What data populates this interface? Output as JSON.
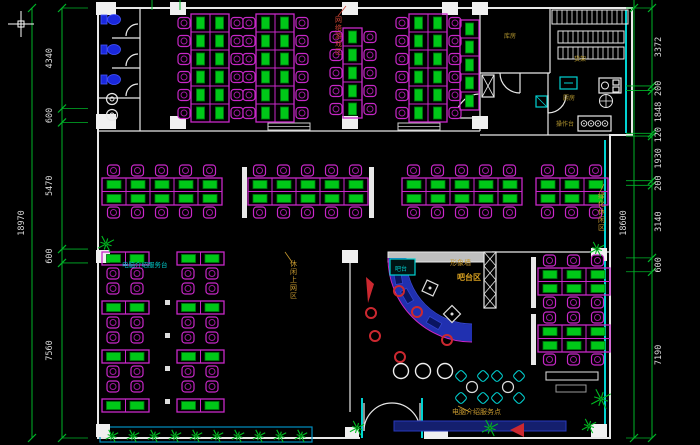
{
  "colors": {
    "bg": "#000000",
    "wall": "#e8e8e8",
    "wall_fill": "#f0f0f0",
    "grey": "#9a9a9a",
    "magenta": "#c828c8",
    "magenta_dark": "#a018a0",
    "green": "#00c818",
    "green_dark": "#007710",
    "dim_green": "#00b428",
    "dim_text": "#d8d8d8",
    "cyan": "#00d2d2",
    "blue_counter": "#2030b0",
    "blue_counter_dark": "#141f6e",
    "toilet_blue": "#1a28dd",
    "red": "#cc2830",
    "yellow": "#c89a30",
    "plant_green": "#00bb22"
  },
  "dimensions": {
    "left": {
      "overall": "18970",
      "segments": [
        "4340",
        "600",
        "5470",
        "600",
        "7560"
      ]
    },
    "right": {
      "overall": "18600",
      "segments": [
        "3372",
        "200",
        "1848",
        "120",
        "1930",
        "200",
        "3140",
        "600",
        "7190"
      ]
    }
  },
  "annotations": [
    {
      "id": "service-desk-left",
      "text": "电脑介绍服务台",
      "x": 122,
      "y": 267,
      "color": "#00c8c8",
      "size": 6.5,
      "vertical": false,
      "bold": false
    },
    {
      "id": "zone-top",
      "text": "网络游戏区",
      "x": 335,
      "y": 22,
      "color": "#cc4433",
      "size": 7,
      "vertical": true,
      "bold": false
    },
    {
      "id": "zone-mid",
      "text": "休闲上网区",
      "x": 290,
      "y": 266,
      "color": "#c89a30",
      "size": 7,
      "vertical": true,
      "bold": false
    },
    {
      "id": "zone-right",
      "text": "绿化休闲区",
      "x": 598,
      "y": 198,
      "color": "#c89a30",
      "size": 7,
      "vertical": true,
      "bold": false
    },
    {
      "id": "feature-wall-label",
      "text": "形象墙",
      "x": 450,
      "y": 265,
      "color": "#c89a30",
      "size": 7,
      "vertical": false,
      "bold": false
    },
    {
      "id": "bar-zone-label",
      "text": "吧台区",
      "x": 457,
      "y": 280,
      "color": "#d8a020",
      "size": 8,
      "vertical": false,
      "bold": true
    },
    {
      "id": "service-desk-bottom",
      "text": "电脑介绍服务点",
      "x": 452,
      "y": 414,
      "color": "#c89a30",
      "size": 7,
      "vertical": false,
      "bold": false
    },
    {
      "id": "room-store-label",
      "text": "库房",
      "x": 504,
      "y": 38,
      "color": "#b89a30",
      "size": 6,
      "vertical": false,
      "bold": false
    },
    {
      "id": "rack-label",
      "text": "货架",
      "x": 574,
      "y": 61,
      "color": "#b89a30",
      "size": 6,
      "vertical": false,
      "bold": false
    },
    {
      "id": "kitchen-label",
      "text": "厨房",
      "x": 563,
      "y": 100,
      "color": "#b89a30",
      "size": 6,
      "vertical": false,
      "bold": false
    },
    {
      "id": "worktop-label",
      "text": "操作台",
      "x": 556,
      "y": 126,
      "color": "#b89a30",
      "size": 6,
      "vertical": false,
      "bold": false
    },
    {
      "id": "bar-sign",
      "text": "吧台",
      "x": 395,
      "y": 271,
      "color": "#00d2d2",
      "size": 6,
      "vertical": false,
      "bold": false
    }
  ],
  "furniture": {
    "v_islands": [
      {
        "x": 178,
        "y": 14,
        "rows": 6,
        "cols": 2,
        "left": true,
        "right": true
      },
      {
        "x": 243,
        "y": 14,
        "rows": 6,
        "cols": 2,
        "left": true,
        "right": true
      },
      {
        "x": 330,
        "y": 28,
        "rows": 5,
        "cols": 1,
        "left": true,
        "right": true
      },
      {
        "x": 396,
        "y": 14,
        "rows": 6,
        "cols": 2,
        "left": true,
        "right": true
      },
      {
        "x": 447,
        "y": 20,
        "rows": 5,
        "cols": 1,
        "left": false,
        "right": false
      }
    ],
    "h_islands": [
      {
        "x": 102,
        "y": 165,
        "units": 5,
        "panels": []
      },
      {
        "x": 248,
        "y": 165,
        "units": 5,
        "panels": [
          242,
          369
        ]
      },
      {
        "x": 402,
        "y": 165,
        "units": 5,
        "panels": []
      },
      {
        "x": 536,
        "y": 165,
        "units": 3,
        "panels": []
      },
      {
        "x": 538,
        "y": 255,
        "units": 3,
        "panels": [
          531
        ]
      },
      {
        "x": 538,
        "y": 312,
        "units": 3,
        "panels": [
          531
        ]
      }
    ],
    "stacks": [
      {
        "x": 102,
        "y": 252,
        "desk_rows": 4
      },
      {
        "x": 177,
        "y": 252,
        "desk_rows": 4
      }
    ],
    "plants": [
      [
        106,
        244,
        9
      ],
      [
        597,
        249,
        8
      ],
      [
        601,
        399,
        11
      ],
      [
        589,
        426,
        8
      ],
      [
        357,
        428,
        8
      ],
      [
        490,
        428,
        9
      ]
    ],
    "planter": {
      "x1": 112,
      "x2": 303,
      "step": 21,
      "y": 436,
      "s": 7
    },
    "red_stools": [
      [
        399,
        291
      ],
      [
        371,
        313
      ],
      [
        375,
        336
      ],
      [
        417,
        312
      ],
      [
        447,
        340
      ],
      [
        400,
        357
      ]
    ],
    "white_stools": [
      [
        401,
        371
      ],
      [
        423,
        371
      ],
      [
        445,
        371
      ]
    ],
    "lounge_tables": [
      [
        472,
        387
      ],
      [
        508,
        387
      ]
    ]
  }
}
